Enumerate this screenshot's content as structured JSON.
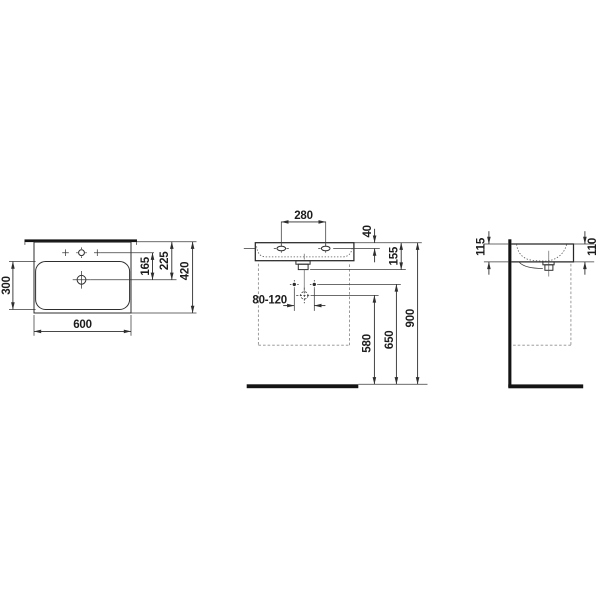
{
  "colors": {
    "background": "#ffffff",
    "line": "#2e2e2e",
    "thick_line": "#141414",
    "dashed_line": "#8f8f8f",
    "text": "#1c1c1c"
  },
  "views": {
    "top": {
      "dims": {
        "width": "600",
        "bowl_depth": "300",
        "tap_line_to_drain": "165",
        "back_edge_to_drain": "225",
        "overall_depth": "420"
      }
    },
    "front": {
      "dims": {
        "tap_hole_spacing": "280",
        "rim_to_tap_holes": "40",
        "rim_to_outlet": "155",
        "fixing_hole_spacing": "80-120",
        "floor_to_drain": "580",
        "floor_to_fixings": "650",
        "floor_to_rim": "900"
      }
    },
    "side": {
      "dims": {
        "body_height_rear": "115",
        "body_height_front": "110"
      }
    }
  }
}
